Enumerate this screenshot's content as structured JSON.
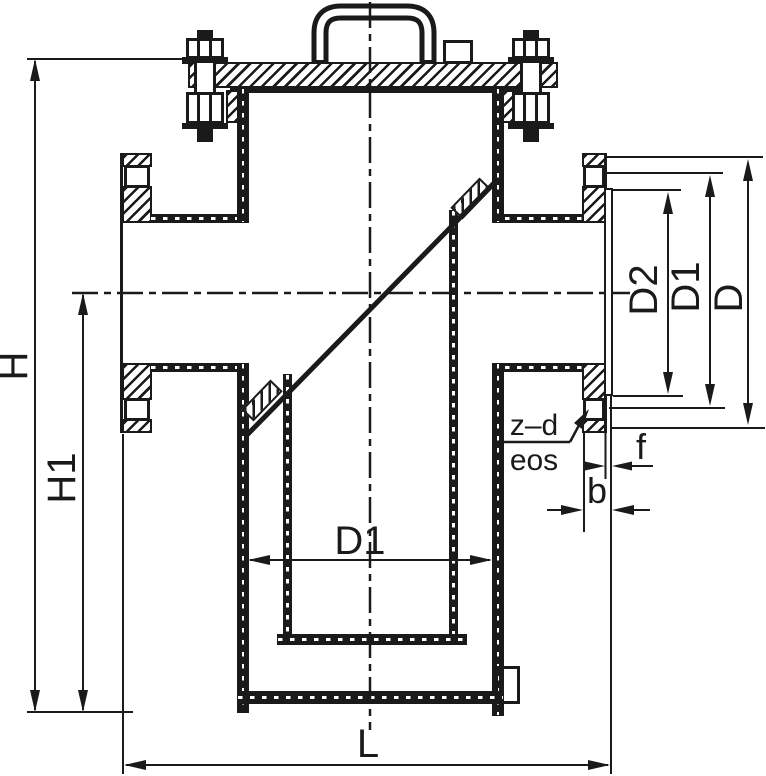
{
  "colors": {
    "line": "#1a1a1a",
    "background": "#ffffff"
  },
  "dimensions": {
    "overall_height": "H",
    "centerline_to_base_height": "H1",
    "basket_inner_diameter": "D1",
    "face_to_face_length": "L",
    "flange": {
      "gasket_face_diameter": "D2",
      "bolt_circle_diameter": "D1",
      "outer_diameter": "D",
      "bolt_holes": "z–d",
      "bolt_holes_note": "eos",
      "raised_face_height": "f",
      "thickness": "b"
    }
  }
}
